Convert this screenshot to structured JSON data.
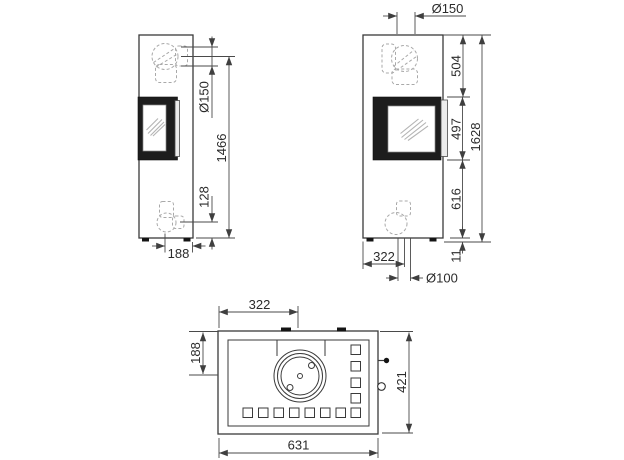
{
  "drawing": {
    "subject": "wood stove three-view dimension drawing",
    "colors": {
      "outline": "#3a3a3a",
      "dimension_lines": "#4a4a4a",
      "hidden_dashed": "#a9a9a9",
      "door_fill": "#1d1d1d",
      "label_text": "#2b2b2b",
      "background": "#ffffff"
    }
  },
  "dims": {
    "side": {
      "flue_diameter": "Ø150",
      "flue_center_height": "1466",
      "outlet_height": "128",
      "outlet_depth": "188"
    },
    "front": {
      "top_flue_diameter": "Ø150",
      "top_section": "504",
      "door_height": "497",
      "total_height": "1628",
      "lower_section": "616",
      "base_height": "11",
      "outlet_offset": "322",
      "bottom_flue_diameter": "Ø100"
    },
    "top": {
      "flue_offset_x": "322",
      "flue_offset_depth": "188",
      "depth": "421",
      "width": "631"
    }
  }
}
